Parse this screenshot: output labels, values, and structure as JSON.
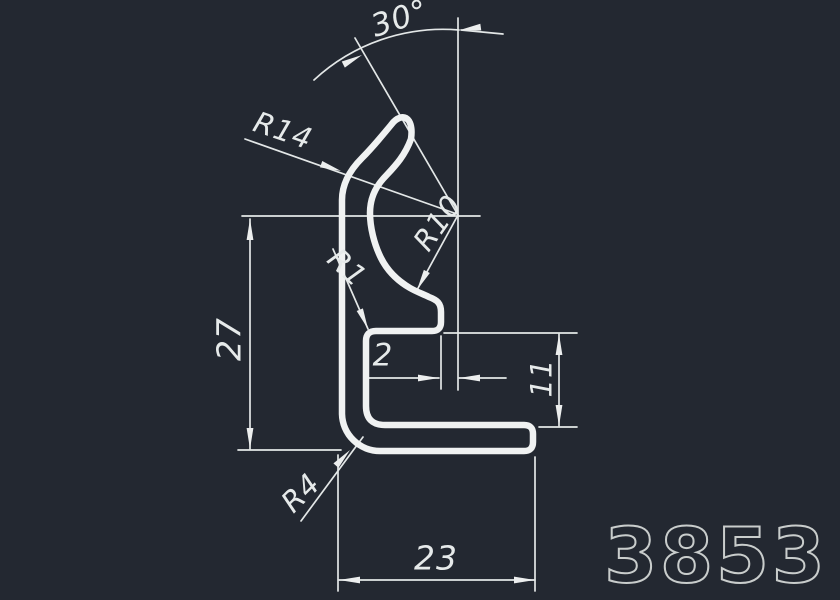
{
  "drawing": {
    "part_number": "3853",
    "colors": {
      "background": "#232831",
      "profile_line": "#f0f2f2",
      "dimension_line": "#e3e7e7",
      "part_number_stroke": "#c9cdcc"
    },
    "dimensions": {
      "angle": "30°",
      "radius_outer": "R14",
      "radius_inner": "R10",
      "radius_root": "R1",
      "radius_corner": "R4",
      "overall_height": "27",
      "wall_offset": "2",
      "opening_height": "11",
      "base_width": "23"
    }
  }
}
